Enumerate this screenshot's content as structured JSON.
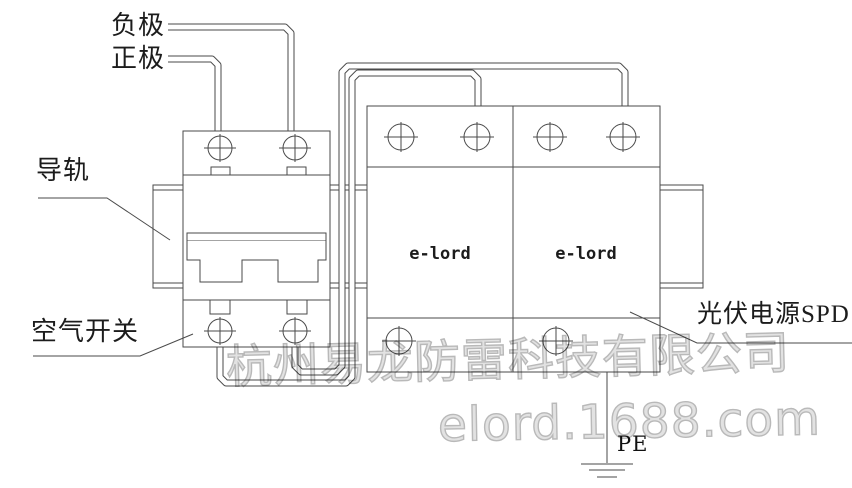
{
  "diagram": {
    "type": "wiring-schematic",
    "labels": {
      "negative": "负极",
      "positive": "正极",
      "rail": "导轨",
      "air_switch": "空气开关",
      "spd": "光伏电源SPD",
      "pe": "PE"
    },
    "spd": {
      "modules": [
        {
          "label": "e-lord"
        },
        {
          "label": "e-lord"
        }
      ]
    },
    "watermarks": {
      "company": "杭州易龙防雷科技有限公司",
      "site": "elord.1688.com"
    },
    "colors": {
      "line": "#4a4a4a",
      "label_text": "#1c1c1c",
      "watermark": "#c9c9c9",
      "background": "#ffffff"
    }
  }
}
